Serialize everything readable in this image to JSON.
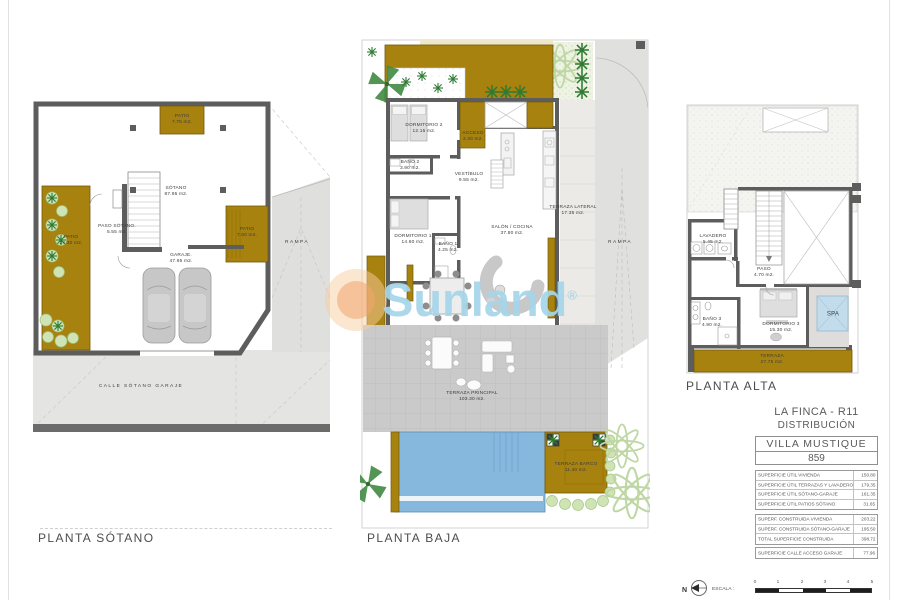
{
  "watermark": {
    "brand": "Sunland",
    "registered": "®"
  },
  "plans": {
    "sotano": {
      "title": "PLANTA SÓTANO",
      "rooms": {
        "sotano": {
          "name": "SÓTANO",
          "area": "87.95 m2."
        },
        "paso": {
          "name": "PASO SÓTANO.",
          "area": "5.55 m2."
        },
        "garaje": {
          "name": "GARAJE.",
          "area": "47.95 m2."
        },
        "patio_top": {
          "name": "PATIO",
          "area": "7.75 m2."
        },
        "patio_left": {
          "name": "PATIO",
          "area": "24.30 m2."
        },
        "patio_right": {
          "name": "PATIO",
          "area": "7.60 m2."
        },
        "rampa": {
          "name": "RAMPA"
        },
        "calle": {
          "name": "CALLE SÓTANO GARAJE"
        }
      }
    },
    "baja": {
      "title": "PLANTA BAJA",
      "rooms": {
        "dormitorio2": {
          "name": "DORMITORIO 2",
          "area": "12.15 m2."
        },
        "bano2": {
          "name": "BAÑO 2",
          "area": "3.90 m2."
        },
        "acceso": {
          "name": "ACCESO",
          "area": "2.40 m2."
        },
        "vestibulo": {
          "name": "VESTÍBULO",
          "area": "9.55 m2."
        },
        "dormitorio1": {
          "name": "DORMITORIO 1",
          "area": "14.60 m2."
        },
        "bano1": {
          "name": "BAÑO 1",
          "area": "4.25 m2."
        },
        "salon": {
          "name": "SALÓN / COCINA",
          "area": "37.80 m2."
        },
        "terraza_lateral": {
          "name": "TERRAZA LATERAL",
          "area": "17.35 m2."
        },
        "terraza_principal": {
          "name": "TERRAZA PRINCIPAL",
          "area": "103.30 m2."
        },
        "terraza_barco": {
          "name": "TERRAZA BARCO",
          "area": "11.40 m2."
        },
        "rampa": {
          "name": "RAMPA"
        }
      }
    },
    "alta": {
      "title": "PLANTA ALTA",
      "rooms": {
        "lavadero": {
          "name": "LAVADERO",
          "area": "5.45 m2."
        },
        "paso": {
          "name": "PASO",
          "area": "4.70 m2."
        },
        "bano3": {
          "name": "BAÑO 3",
          "area": "4.90 m2."
        },
        "dormitorio3": {
          "name": "DORMITORIO 3",
          "area": "15.30 m2."
        },
        "spa": {
          "name": "SPA"
        },
        "terraza": {
          "name": "TERRAZA",
          "area": "27.75 m2."
        }
      }
    }
  },
  "title_block": {
    "project": "LA FINCA - R11",
    "subtitle": "DISTRIBUCIÓN",
    "villa_name": "VILLA MUSTIQUE",
    "villa_number": "859",
    "tables": [
      {
        "rows": [
          {
            "label": "SUPERFICIE ÚTIL VIVIENDA",
            "value": "150.80"
          },
          {
            "label": "SUPERFICIE ÚTIL TERRAZAS Y LAVADERO",
            "value": "179.35"
          },
          {
            "label": "SUPERFICIE ÚTIL SÓTANO-GARAJE",
            "value": "161.35"
          },
          {
            "label": "SUPERFICIE ÚTIL PATIOS SÓTANO",
            "value": "31.65"
          }
        ]
      },
      {
        "rows": [
          {
            "label": "SUPERF. CONSTRUIDA VIVIENDA",
            "value": "203.22"
          },
          {
            "label": "SUPERF. CONSTRUIDA SÓTANO-GARAJE",
            "value": "195.50"
          },
          {
            "label": "TOTAL SUPERFICIE CONSTRUIDA",
            "value": "398.72"
          }
        ]
      },
      {
        "rows": [
          {
            "label": "SUPERFICIE CALLE ACCESO GARAJE",
            "value": "77.96"
          }
        ]
      }
    ]
  },
  "scale_bar": {
    "north": "N",
    "label": "ESCALA :",
    "ticks": [
      "0",
      "1",
      "2",
      "3",
      "4",
      "5"
    ]
  },
  "colors": {
    "gold": "#a8820f",
    "wall": "#5d5d5d",
    "pool": "#86b8de",
    "spa": "#c2dcec",
    "terrace_gray": "#cacaca",
    "ramp_gray": "#e0e0de",
    "garden_green": "#eef3e3",
    "plant_dark_green": "#2f7a33",
    "bush_green": "#cfe3b4",
    "watermark_blue": "#a5d5e8",
    "watermark_orange": "#f2a46e"
  }
}
